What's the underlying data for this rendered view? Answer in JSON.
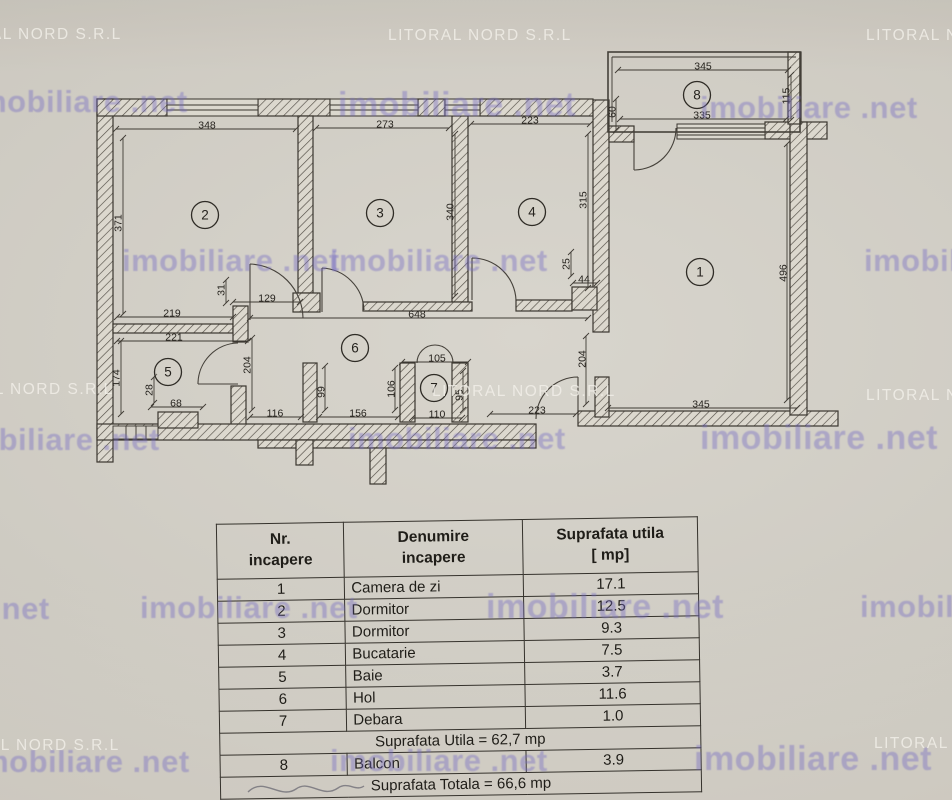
{
  "watermarks": {
    "brand": "imobiliare .net",
    "agency": "LITORAL NORD S.R.L"
  },
  "plan": {
    "rooms": [
      {
        "n": "1",
        "x": 700,
        "y": 272
      },
      {
        "n": "2",
        "x": 205,
        "y": 215
      },
      {
        "n": "3",
        "x": 380,
        "y": 213
      },
      {
        "n": "4",
        "x": 532,
        "y": 212
      },
      {
        "n": "5",
        "x": 168,
        "y": 372
      },
      {
        "n": "6",
        "x": 355,
        "y": 348
      },
      {
        "n": "7",
        "x": 434,
        "y": 388
      },
      {
        "n": "8",
        "x": 697,
        "y": 95
      }
    ],
    "dimensions": [
      {
        "t": "348",
        "lx": 207,
        "ly": 125,
        "x1": 116,
        "y1": 129,
        "x2": 296,
        "y2": 129
      },
      {
        "t": "273",
        "lx": 385,
        "ly": 124,
        "x1": 316,
        "y1": 128,
        "x2": 449,
        "y2": 128
      },
      {
        "t": "223",
        "lx": 530,
        "ly": 120,
        "x1": 471,
        "y1": 124,
        "x2": 590,
        "y2": 124
      },
      {
        "t": "345",
        "lx": 703,
        "ly": 66,
        "x1": 618,
        "y1": 70,
        "x2": 788,
        "y2": 70
      },
      {
        "t": "335",
        "lx": 702,
        "ly": 115,
        "x1": 620,
        "y1": 119,
        "x2": 786,
        "y2": 119
      },
      {
        "t": "115",
        "lx": 786,
        "ly": 96,
        "x1": 791,
        "y1": 75,
        "x2": 791,
        "y2": 120,
        "rot": -90
      },
      {
        "t": "60",
        "lx": 612,
        "ly": 112,
        "x1": 616,
        "y1": 99,
        "x2": 616,
        "y2": 130,
        "rot": -90
      },
      {
        "t": "371",
        "lx": 118,
        "ly": 223,
        "x1": 123,
        "y1": 138,
        "x2": 123,
        "y2": 314,
        "rot": -90
      },
      {
        "t": "340",
        "lx": 450,
        "ly": 212,
        "x1": 455,
        "y1": 134,
        "x2": 455,
        "y2": 296,
        "rot": -90
      },
      {
        "t": "315",
        "lx": 583,
        "ly": 200,
        "x1": 588,
        "y1": 134,
        "x2": 588,
        "y2": 288,
        "rot": -90
      },
      {
        "t": "31",
        "lx": 221,
        "ly": 290,
        "x1": 226,
        "y1": 280,
        "x2": 226,
        "y2": 303,
        "rot": -90
      },
      {
        "t": "129",
        "lx": 267,
        "ly": 298,
        "x1": 233,
        "y1": 302,
        "x2": 300,
        "y2": 302
      },
      {
        "t": "219",
        "lx": 172,
        "ly": 313,
        "x1": 117,
        "y1": 317,
        "x2": 233,
        "y2": 317
      },
      {
        "t": "648",
        "lx": 417,
        "ly": 314,
        "x1": 250,
        "y1": 318,
        "x2": 588,
        "y2": 318
      },
      {
        "t": "221",
        "lx": 174,
        "ly": 337,
        "x1": 117,
        "y1": 341,
        "x2": 248,
        "y2": 341
      },
      {
        "t": "25",
        "lx": 566,
        "ly": 264,
        "x1": 571,
        "y1": 252,
        "x2": 571,
        "y2": 276,
        "rot": -90
      },
      {
        "t": "44",
        "lx": 584,
        "ly": 279,
        "x1": 573,
        "y1": 283,
        "x2": 597,
        "y2": 283
      },
      {
        "t": "496",
        "lx": 783,
        "ly": 273,
        "x1": 787,
        "y1": 144,
        "x2": 787,
        "y2": 400,
        "rot": -90
      },
      {
        "t": "174",
        "lx": 116,
        "ly": 378,
        "x1": 121,
        "y1": 341,
        "x2": 121,
        "y2": 414,
        "rot": -90
      },
      {
        "t": "28",
        "lx": 149,
        "ly": 390,
        "x1": 154,
        "y1": 377,
        "x2": 154,
        "y2": 403,
        "rot": -90
      },
      {
        "t": "68",
        "lx": 176,
        "ly": 403,
        "x1": 151,
        "y1": 407,
        "x2": 203,
        "y2": 407
      },
      {
        "t": "204",
        "lx": 247,
        "ly": 365,
        "x1": 252,
        "y1": 338,
        "x2": 252,
        "y2": 410,
        "rot": -90
      },
      {
        "t": "116",
        "lx": 275,
        "ly": 413,
        "x1": 250,
        "y1": 417,
        "x2": 301,
        "y2": 417
      },
      {
        "t": "99",
        "lx": 321,
        "ly": 392,
        "x1": 325,
        "y1": 366,
        "x2": 325,
        "y2": 410,
        "rot": -90
      },
      {
        "t": "156",
        "lx": 358,
        "ly": 413,
        "x1": 319,
        "y1": 417,
        "x2": 398,
        "y2": 417
      },
      {
        "t": "105",
        "lx": 437,
        "ly": 358,
        "x1": 402,
        "y1": 362,
        "x2": 468,
        "y2": 362
      },
      {
        "t": "106",
        "lx": 391,
        "ly": 389,
        "x1": 395,
        "y1": 368,
        "x2": 395,
        "y2": 410,
        "rot": -90
      },
      {
        "t": "95",
        "lx": 459,
        "ly": 395,
        "x1": 463,
        "y1": 371,
        "x2": 463,
        "y2": 410,
        "rot": -90
      },
      {
        "t": "110",
        "lx": 437,
        "ly": 414,
        "x1": 412,
        "y1": 418,
        "x2": 462,
        "y2": 418
      },
      {
        "t": "204",
        "lx": 582,
        "ly": 359,
        "x1": 586,
        "y1": 336,
        "x2": 586,
        "y2": 404,
        "rot": -90
      },
      {
        "t": "223",
        "lx": 537,
        "ly": 410,
        "x1": 490,
        "y1": 414,
        "x2": 576,
        "y2": 414
      },
      {
        "t": "345",
        "lx": 701,
        "ly": 404,
        "x1": 608,
        "y1": 408,
        "x2": 797,
        "y2": 408
      }
    ]
  },
  "table": {
    "headers": [
      "Nr.\nincapere",
      "Denumire\nincapere",
      "Suprafata utila\n[ mp]"
    ],
    "rows": [
      {
        "nr": "1",
        "name": "Camera de zi",
        "area": "17.1"
      },
      {
        "nr": "2",
        "name": "Dormitor",
        "area": "12.5"
      },
      {
        "nr": "3",
        "name": "Dormitor",
        "area": "9.3"
      },
      {
        "nr": "4",
        "name": "Bucatarie",
        "area": "7.5"
      },
      {
        "nr": "5",
        "name": "Baie",
        "area": "3.7"
      },
      {
        "nr": "6",
        "name": "Hol",
        "area": "11.6"
      },
      {
        "nr": "7",
        "name": "Debara",
        "area": "1.0"
      },
      {
        "merged": "Suprafata Utila = 62,7 mp"
      },
      {
        "nr": "8",
        "name": "Balcon",
        "area": "3.9"
      },
      {
        "merged": "Suprafata Totala = 66,6 mp"
      }
    ]
  }
}
